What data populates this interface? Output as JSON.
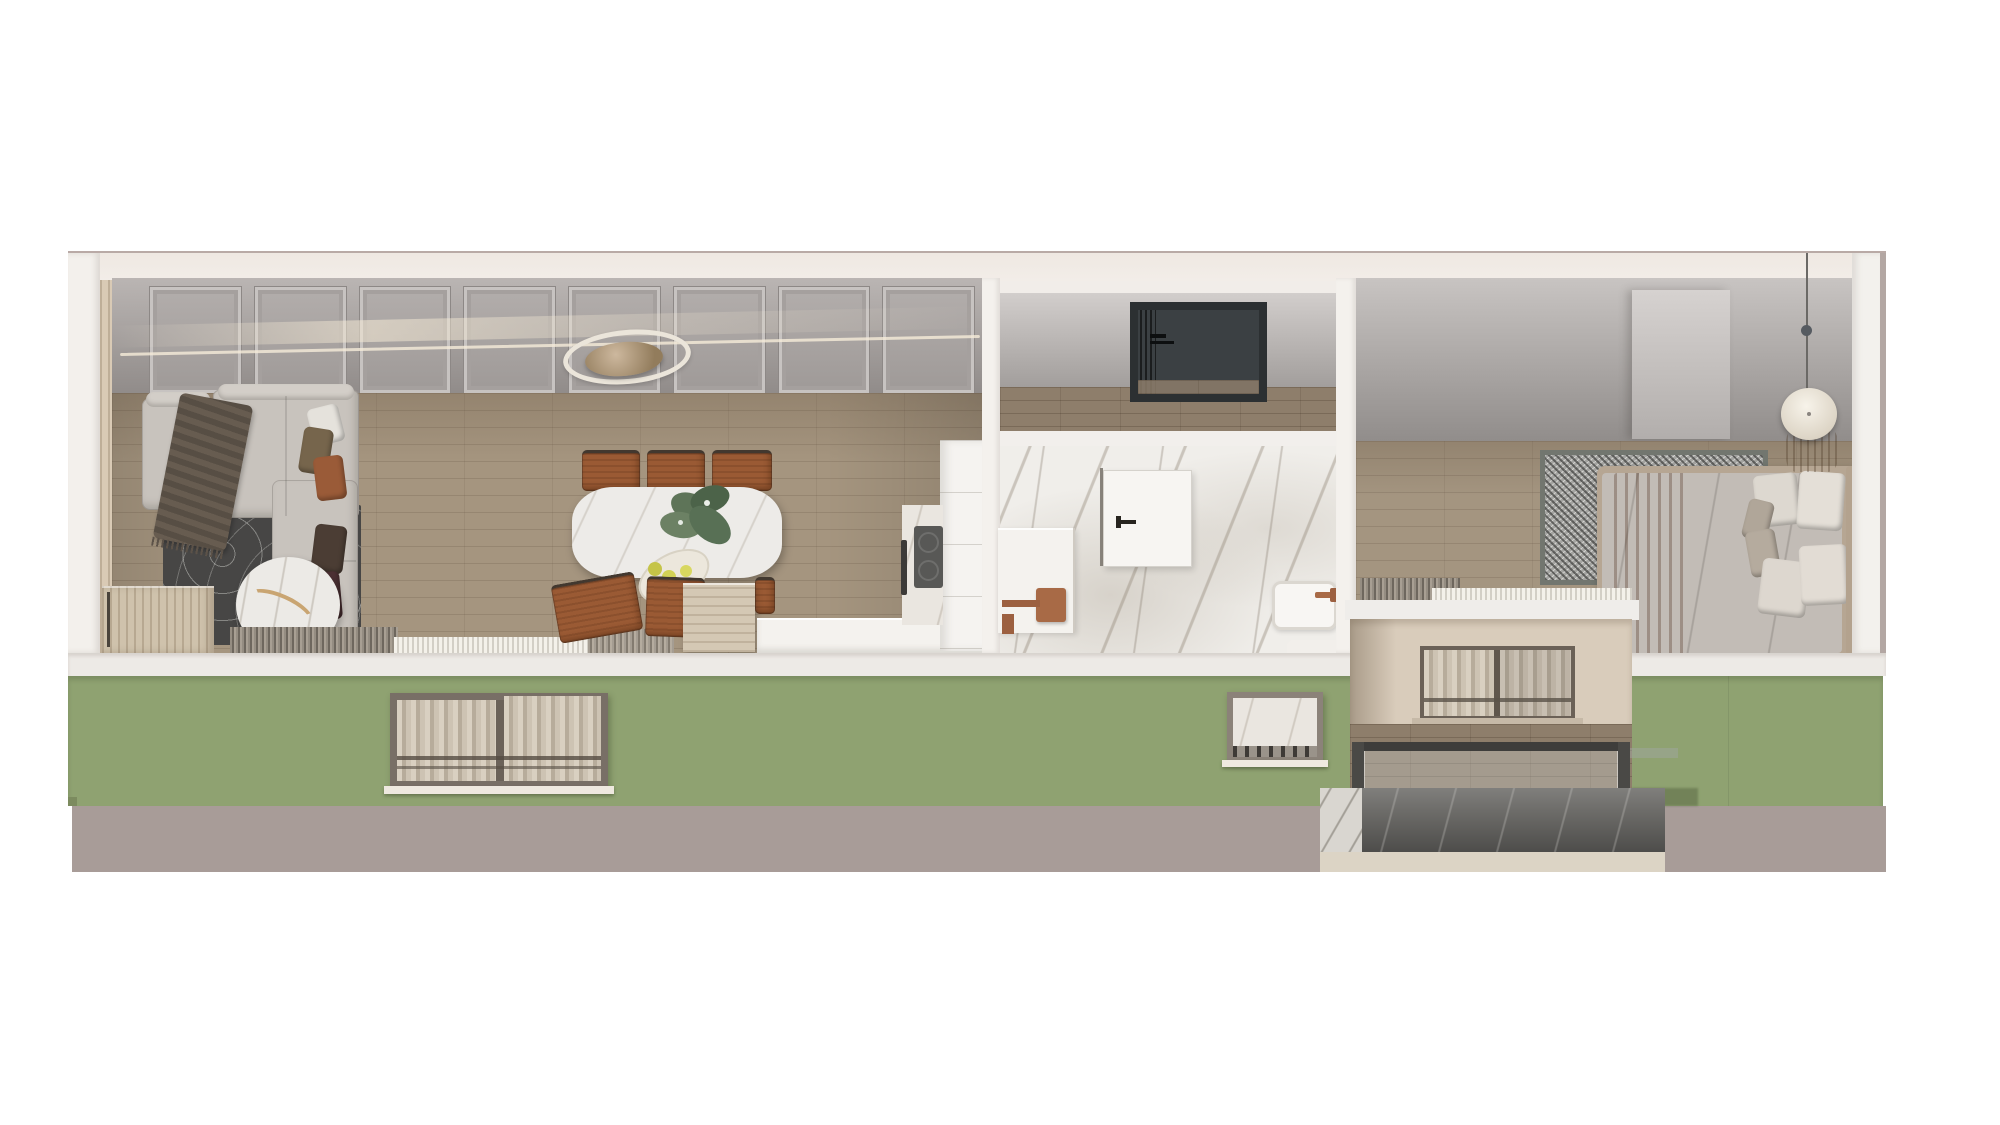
{
  "meta": {
    "title": "Apartment cutaway 3D render",
    "view": "dollhouse section, top-front view",
    "has_text": false
  },
  "palette": {
    "page_background": "#ffffff",
    "ceiling_cut_cream": "#f0ebe6",
    "slab_white": "#edeae6",
    "facade_green": "#8fa271",
    "facade_base_mauve": "#a89c98",
    "interior_wall_gray": "#a5a09d",
    "wood_floor": "#a5957f",
    "marble_white": "#f0eeea",
    "copper_fixture": "#a86a46",
    "cognac_leather": "#9a5a34",
    "terracotta_throw": "#a7653f",
    "entry_niche_charcoal": "#3b4043",
    "balcony_stone_dark": "#6b6a67",
    "sofa_gray": "#c8c3bd"
  },
  "rooms": {
    "living_dining": {
      "label": "Living and dining room",
      "wall": "gray panel molding wall with light reflection",
      "furniture": [
        "sectional sofa",
        "brown throw blanket",
        "five cushions",
        "topographic rug",
        "round marble coffee table with gold branch decor",
        "wood sideboard",
        "oval marble dining table",
        "cognac leather dining chairs",
        "plant centerpiece",
        "plate of green apples",
        "ring chandelier",
        "window curtains"
      ]
    },
    "kitchen": {
      "label": "Kitchen corner",
      "furniture": [
        "white tall cabinets",
        "counter with cooktop",
        "white island front"
      ]
    },
    "hallway": {
      "label": "Entry hallway",
      "furniture": [
        "dark charcoal entry niche with black handle",
        "wood floor"
      ]
    },
    "bathroom": {
      "label": "Bathroom",
      "furniture": [
        "marble walls and floor",
        "white shower enclosure with copper fixtures",
        "white door with black handle",
        "white basin with copper faucet",
        "bidet"
      ]
    },
    "bedroom": {
      "label": "Bedroom",
      "furniture": [
        "upholstered bed with gray duvet",
        "terracotta runner",
        "six pillows",
        "mottled gray rug",
        "round wood nightstand",
        "disc pendant lamp",
        "partition panel",
        "window curtains and radiator"
      ]
    },
    "balcony": {
      "label": "Recessed balcony",
      "furniture": [
        "sliding glass door with sheer curtains",
        "wood deck",
        "metal and glass railing",
        "dark stone base"
      ]
    }
  },
  "facade": {
    "wall_color_name": "sage green",
    "base_color_name": "mauve gray",
    "windows": [
      {
        "name": "living room window",
        "panes": 2,
        "content": "sheer curtains"
      },
      {
        "name": "bathroom window",
        "panes": 1,
        "content": "marble interior"
      }
    ]
  },
  "counts": {
    "dining_chairs_visible": 6,
    "sofa_cushions": 5,
    "bed_pillows": 6,
    "wall_panels": 8
  }
}
